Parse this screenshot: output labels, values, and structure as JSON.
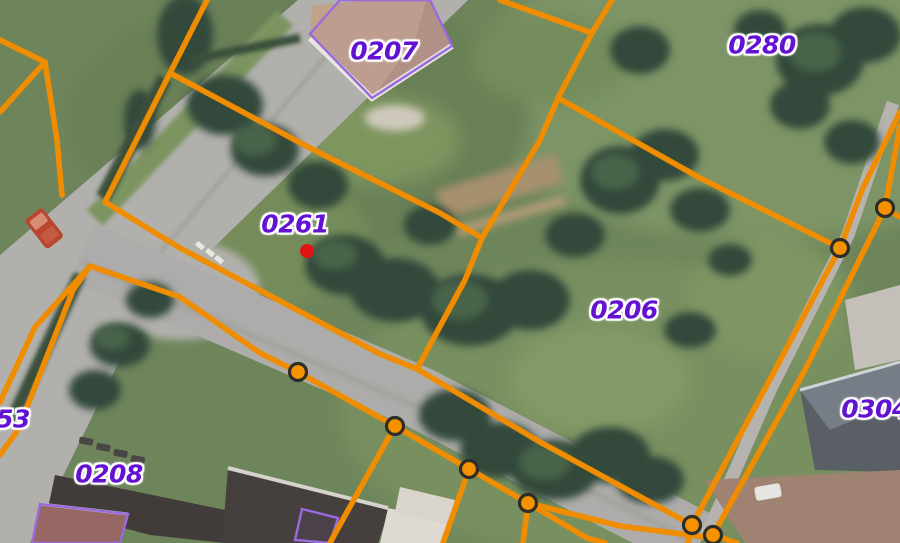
{
  "map": {
    "parcel_labels": [
      {
        "id": "0207",
        "x": 384,
        "y": 51
      },
      {
        "id": "0280",
        "x": 762,
        "y": 45
      },
      {
        "id": "0261",
        "x": 295,
        "y": 224
      },
      {
        "id": "0206",
        "x": 624,
        "y": 310
      },
      {
        "id": "0304",
        "x": 875,
        "y": 409
      },
      {
        "id": "0208",
        "x": 109,
        "y": 474
      },
      {
        "id": "53",
        "x": 13,
        "y": 419
      }
    ],
    "selected_point": {
      "x": 307,
      "y": 251,
      "color": "#e31313",
      "radius": 7
    },
    "colors": {
      "boundary": "#f08c00",
      "vertex_fill": "#f49200",
      "vertex_ring": "#2f2d2a",
      "label": "#6212d0",
      "label_halo": "#ffffff",
      "building_outline": "#9a6ade"
    },
    "boundaries": [
      {
        "points": [
          [
            0,
            40
          ],
          [
            45,
            62
          ]
        ]
      },
      {
        "points": [
          [
            45,
            62
          ],
          [
            0,
            112
          ]
        ]
      },
      {
        "points": [
          [
            45,
            62
          ],
          [
            57,
            140
          ],
          [
            62,
            195
          ]
        ]
      },
      {
        "points": [
          [
            207,
            0
          ],
          [
            170,
            73
          ]
        ]
      },
      {
        "points": [
          [
            170,
            73
          ],
          [
            105,
            202
          ]
        ]
      },
      {
        "points": [
          [
            105,
            202
          ],
          [
            180,
            248
          ],
          [
            380,
            354
          ],
          [
            417,
            369
          ],
          [
            540,
            442
          ],
          [
            692,
            525
          ]
        ]
      },
      {
        "points": [
          [
            170,
            73
          ],
          [
            310,
            148
          ],
          [
            440,
            213
          ],
          [
            482,
            238
          ]
        ]
      },
      {
        "points": [
          [
            612,
            0
          ],
          [
            592,
            33
          ],
          [
            558,
            98
          ],
          [
            540,
            140
          ],
          [
            482,
            238
          ],
          [
            465,
            280
          ],
          [
            417,
            369
          ]
        ]
      },
      {
        "points": [
          [
            592,
            33
          ],
          [
            500,
            0
          ]
        ]
      },
      {
        "points": [
          [
            558,
            98
          ],
          [
            700,
            178
          ],
          [
            840,
            248
          ]
        ]
      },
      {
        "points": [
          [
            90,
            266
          ],
          [
            180,
            297
          ],
          [
            260,
            353
          ],
          [
            298,
            372
          ],
          [
            395,
            426
          ],
          [
            469,
            469
          ],
          [
            528,
            503
          ],
          [
            620,
            526
          ],
          [
            705,
            537
          ]
        ]
      },
      {
        "points": [
          [
            90,
            266
          ],
          [
            35,
            327
          ],
          [
            0,
            402
          ]
        ]
      },
      {
        "points": [
          [
            90,
            266
          ],
          [
            73,
            290
          ],
          [
            18,
            430
          ],
          [
            0,
            455
          ]
        ]
      },
      {
        "points": [
          [
            395,
            426
          ],
          [
            337,
            530
          ],
          [
            330,
            543
          ]
        ]
      },
      {
        "points": [
          [
            469,
            469
          ],
          [
            443,
            543
          ]
        ]
      },
      {
        "points": [
          [
            528,
            503
          ],
          [
            523,
            543
          ]
        ]
      },
      {
        "points": [
          [
            528,
            503
          ],
          [
            587,
            538
          ],
          [
            605,
            543
          ]
        ]
      },
      {
        "points": [
          [
            900,
            112
          ],
          [
            862,
            190
          ],
          [
            840,
            248
          ],
          [
            760,
            398
          ],
          [
            692,
            525
          ]
        ]
      },
      {
        "points": [
          [
            900,
            126
          ],
          [
            885,
            208
          ],
          [
            806,
            368
          ],
          [
            713,
            535
          ]
        ]
      },
      {
        "points": [
          [
            885,
            208
          ],
          [
            900,
            217
          ]
        ]
      },
      {
        "points": [
          [
            692,
            525
          ],
          [
            688,
            543
          ]
        ]
      },
      {
        "points": [
          [
            713,
            535
          ],
          [
            737,
            543
          ]
        ]
      }
    ],
    "vertices": [
      [
        298,
        372
      ],
      [
        395,
        426
      ],
      [
        469,
        469
      ],
      [
        528,
        503
      ],
      [
        692,
        525
      ],
      [
        713,
        535
      ],
      [
        885,
        208
      ],
      [
        840,
        248
      ]
    ],
    "building_outlines": [
      {
        "points": [
          [
            340,
            0
          ],
          [
            310,
            34
          ],
          [
            372,
            98
          ],
          [
            452,
            46
          ],
          [
            430,
            0
          ]
        ]
      },
      {
        "points": [
          [
            40,
            504
          ],
          [
            128,
            514
          ],
          [
            120,
            543
          ],
          [
            32,
            543
          ]
        ]
      },
      {
        "points": [
          [
            302,
            509
          ],
          [
            338,
            518
          ],
          [
            330,
            543
          ],
          [
            295,
            540
          ]
        ]
      }
    ]
  }
}
